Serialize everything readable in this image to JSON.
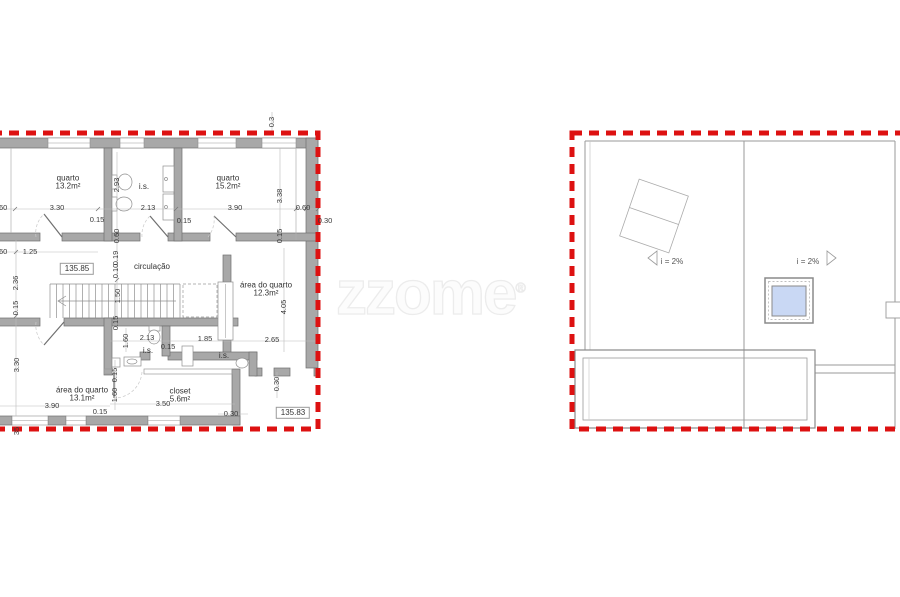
{
  "watermark": {
    "text": "zzome",
    "registered": "®"
  },
  "floor_plan": {
    "levels": {
      "upper": "135.85",
      "lower": "135.83"
    },
    "rooms": {
      "quarto1": {
        "label": "quarto",
        "area": "13.2m²"
      },
      "is_top": {
        "label": "i.s."
      },
      "quarto2": {
        "label": "quarto",
        "area": "15.2m²"
      },
      "circulacao": {
        "label": "circulação"
      },
      "area_quarto_right": {
        "label": "área do quarto",
        "area": "12.3m²"
      },
      "is_mid": {
        "label": "i.s."
      },
      "is_right": {
        "label": "i.s."
      },
      "area_quarto_bottom": {
        "label": "área do quarto",
        "area": "13.1m²"
      },
      "closet": {
        "label": "closet",
        "area": "5.6m²"
      }
    },
    "dims_h": [
      "3.30",
      "0.15",
      "2.13",
      "0.15",
      "3.90",
      "0.60",
      "0.30",
      "0.60",
      "0.60",
      "1.25",
      "1.85",
      "2.65",
      "2.13",
      "0.15",
      "3.90",
      "0.15",
      "3.50",
      "0.30"
    ],
    "dims_v": [
      "2.93",
      "0.60",
      "3.38",
      "0.15",
      "0.3",
      "2.36",
      "0.15",
      "0.19",
      "0.10",
      "1.50",
      "0.15",
      "1.60",
      "3.30",
      "0.15",
      "1.60",
      "4.05",
      "0.30",
      "35"
    ]
  },
  "roof_plan": {
    "slope_left": "i = 2%",
    "slope_right": "i = 2%"
  },
  "colors": {
    "boundary_red": "#dd1111",
    "wall_gray": "#a8a8a8",
    "skylight_blue": "#c9d8f4"
  }
}
